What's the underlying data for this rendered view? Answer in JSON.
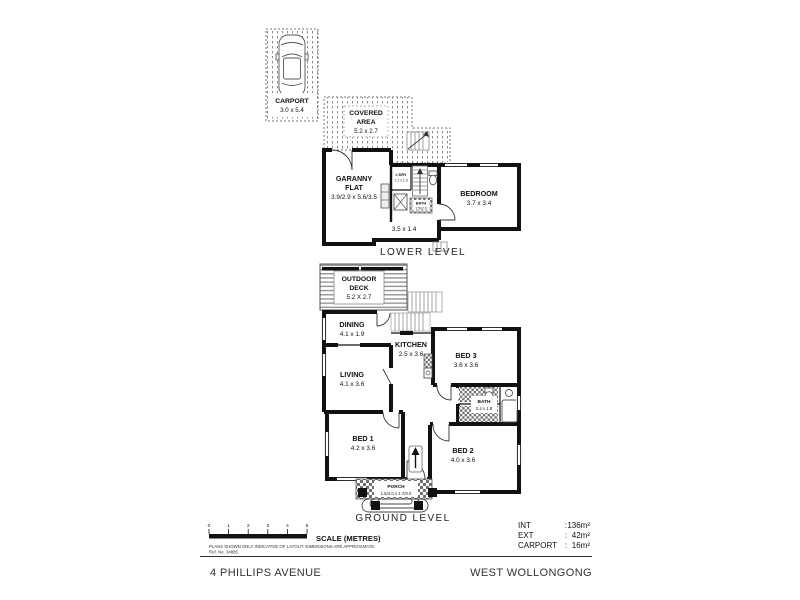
{
  "property": {
    "address": "4 PHILLIPS AVENUE",
    "suburb": "WEST WOLLONGONG"
  },
  "lower_level": {
    "title": "LOWER LEVEL",
    "carport": {
      "name": "CARPORT",
      "dims": "3.0 x 5.4"
    },
    "covered_area": {
      "line1": "COVERED",
      "line2": "AREA",
      "dims": "5.2 x 2.7"
    },
    "granny_flat": {
      "line1": "GARANNY",
      "line2": "FLAT",
      "dims": "3.9/2.9 x 5.6/3.5"
    },
    "laundry": {
      "name": "L'DRY",
      "dims": "1.1 x 1.3"
    },
    "bath": {
      "name": "BATH",
      "dims": "1.5x2.0"
    },
    "bedroom": {
      "name": "BEDROOM",
      "dims": "3.7 x 3.4"
    },
    "hall_dims": "3.5 x 1.4"
  },
  "ground_level": {
    "title": "GROUND LEVEL",
    "deck": {
      "line1": "OUTDOOR",
      "line2": "DECK",
      "dims": "5.2 X 2.7"
    },
    "dining": {
      "name": "DINING",
      "dims": "4.1 x 1.9"
    },
    "kitchen": {
      "name": "KITCHEN",
      "dims": "2.5 x 3.6"
    },
    "bed3": {
      "name": "BED 3",
      "dims": "3.6 x 3.6"
    },
    "living": {
      "name": "LIVING",
      "dims": "4.1 x 3.6"
    },
    "bath": {
      "name": "BATH",
      "dims": "2.4 x 1.8"
    },
    "bed1": {
      "name": "BED 1",
      "dims": "4.2 x 3.6"
    },
    "bed2": {
      "name": "BED 2",
      "dims": "4.0 x 3.6"
    },
    "porch": {
      "name": "PORCH",
      "dims": "1.5/4.0 x 1.7/3.0"
    }
  },
  "scale_bar": {
    "ticks": [
      "0",
      "1",
      "2",
      "3",
      "4",
      "5"
    ],
    "label": "SCALE (METRES)"
  },
  "disclaimer": {
    "line1": "PLANS SHOWN ONLY INDICATIVE OF LAYOUT.  DIMENSIONS ARE APPROXIMATE.",
    "ref": "Ref. No. 34885"
  },
  "areas": {
    "sep": ":",
    "int": {
      "label": "INT",
      "value": "136m²"
    },
    "ext": {
      "label": "EXT",
      "value": "42m²"
    },
    "carport": {
      "label": "CARPORT",
      "value": "16m²"
    }
  },
  "colors": {
    "wall": "#111111",
    "pattern_gray": "#8a8a8a",
    "background": "#ffffff"
  }
}
